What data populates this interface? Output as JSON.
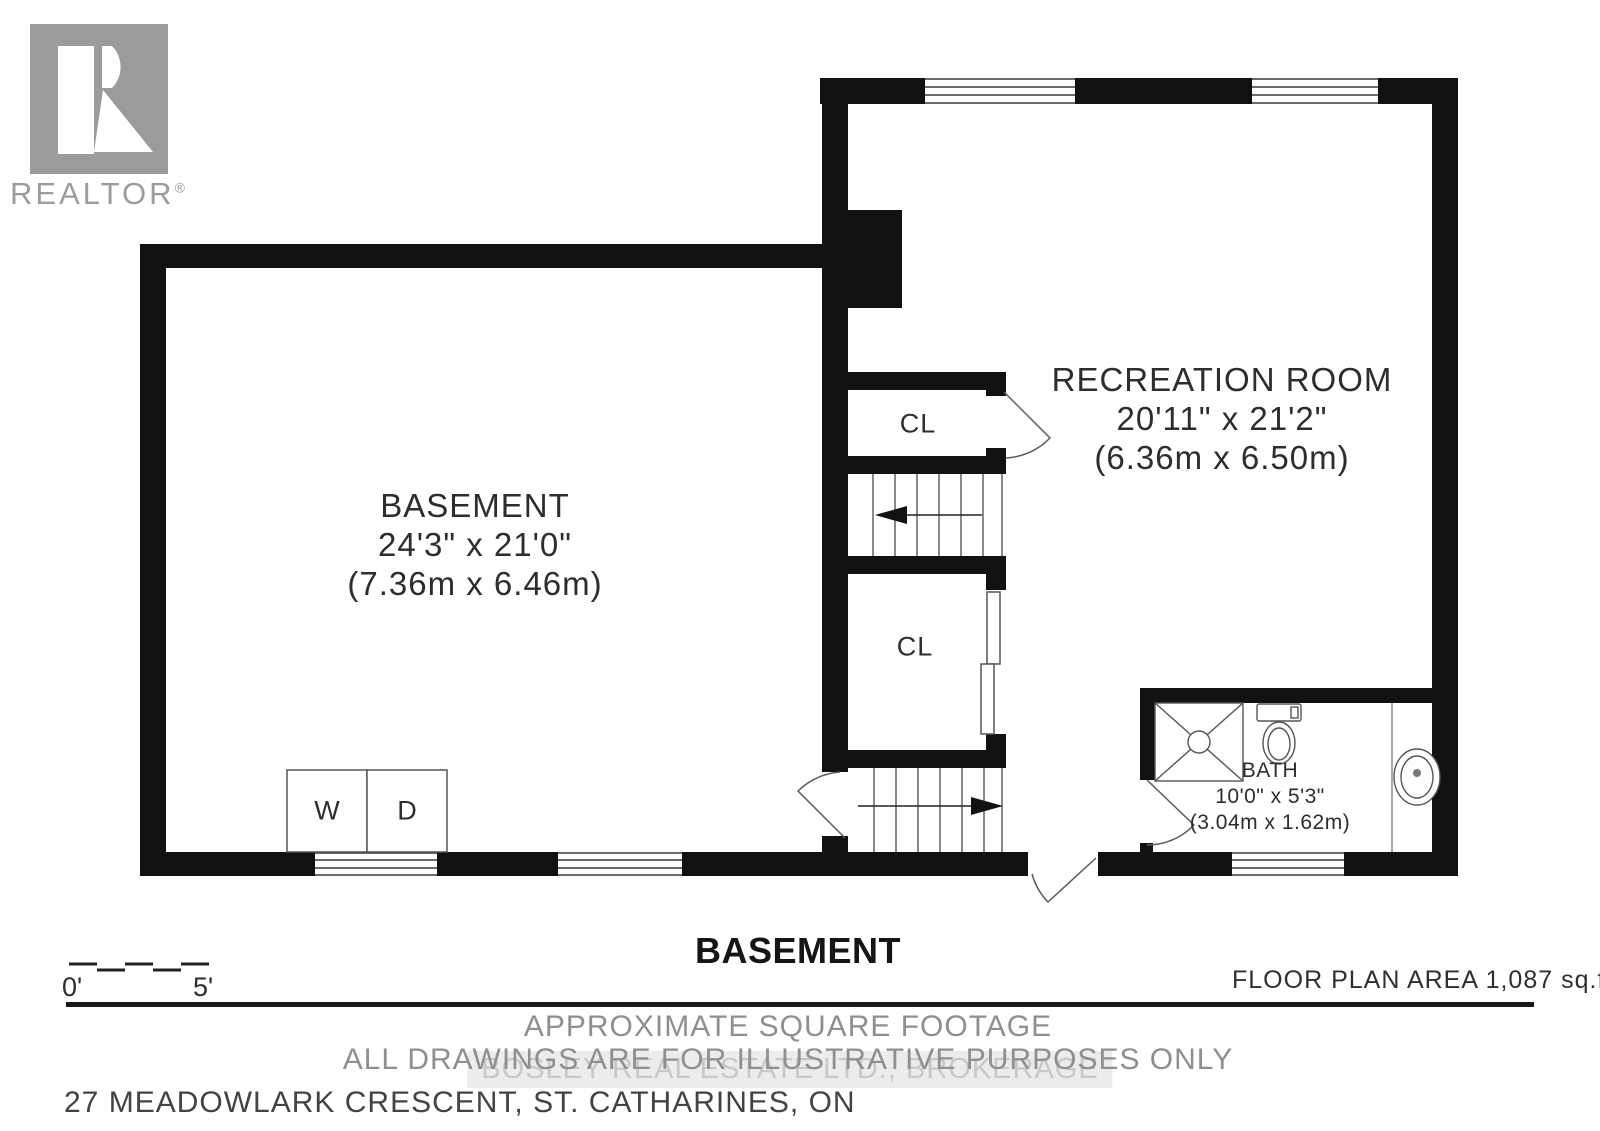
{
  "logo": {
    "brand": "REALTOR",
    "registered": "®"
  },
  "rooms": {
    "basement": {
      "name": "BASEMENT",
      "dims_imperial": "24'3\" x 21'0\"",
      "dims_metric": "(7.36m x 6.46m)"
    },
    "recreation": {
      "name": "RECREATION ROOM",
      "dims_imperial": "20'11\" x 21'2\"",
      "dims_metric": "(6.36m x 6.50m)"
    },
    "bath": {
      "name": "BATH",
      "dims_imperial": "10'0\" x 5'3\"",
      "dims_metric": "(3.04m x 1.62m)"
    },
    "closet_upper": "CL",
    "closet_lower": "CL",
    "washer": "W",
    "dryer": "D"
  },
  "footer": {
    "floor_title": "BASEMENT",
    "scale_start": "0'",
    "scale_end": "5'",
    "area_label": "FLOOR PLAN AREA 1,087 sq.ft.",
    "disclaimer_line1": "APPROXIMATE SQUARE FOOTAGE",
    "disclaimer_line2": "ALL DRAWINGS ARE FOR ILLUSTRATIVE PURPOSES ONLY",
    "watermark": "BOSLEY REAL ESTATE LTD., BROKERAGE",
    "address": "27 MEADOWLARK CRESCENT, ST. CATHARINES, ON"
  },
  "colors": {
    "wall": "#111111",
    "fixture_line": "#4a4a4a",
    "room_text": "#2d2d2d",
    "footer_gray": "#8f8f8f",
    "logo_gray": "#9c9c9c",
    "watermark_text": "#c8c8c8"
  }
}
